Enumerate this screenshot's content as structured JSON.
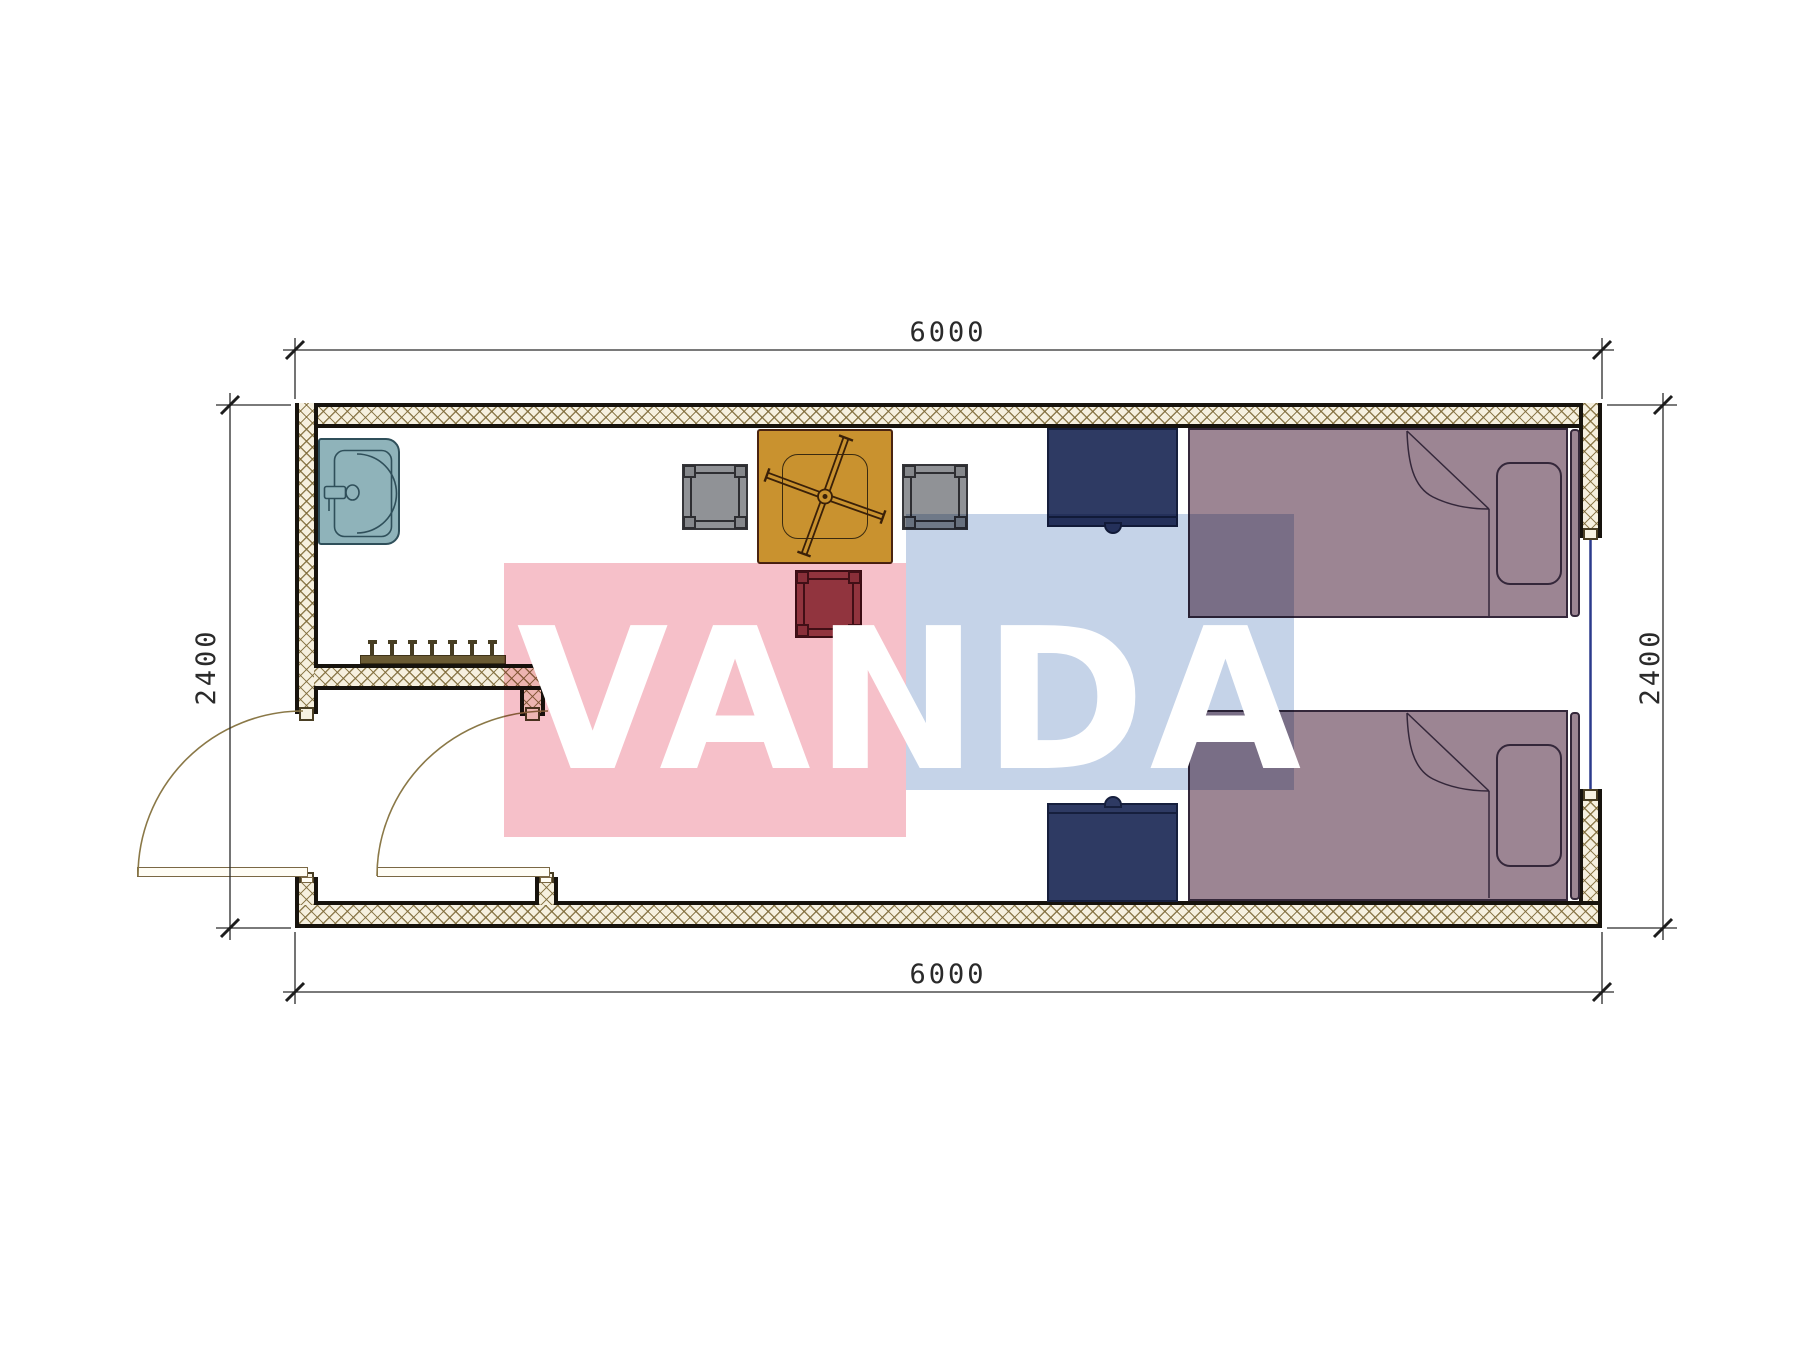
{
  "document": {
    "type": "architectural floor plan of a 6000x2400 container room with two beds",
    "background_color": "#ffffff"
  },
  "dimensions": {
    "top_width_mm": "6000",
    "bottom_width_mm": "6000",
    "left_height_mm": "2400",
    "right_height_mm": "2400"
  },
  "watermark": {
    "text": "VANDA",
    "pink_color": "#f6c0c9",
    "blue_color": "#c5d3e8",
    "text_color": "#ffffff"
  },
  "palette": {
    "wall_hatch_bg": "#f6f0df",
    "wall_hatch_line": "#7d6937",
    "wall_edge": "#17130d",
    "sink": "#8fb3ba",
    "table": "#c9922f",
    "chair_gray": "#909296",
    "chair_red": "#96454e",
    "nightstand_navy": "#2e3a63",
    "bed_mauve": "#9c8593",
    "door_line": "#8a7847",
    "window_line": "#2b3a8c",
    "dimension_line": "#2a2a2a"
  },
  "furniture": [
    "sink",
    "coat-rack",
    "square-table-with-fan",
    "chair-left",
    "chair-right",
    "chair-bottom-red",
    "nightstand-top",
    "nightstand-bottom",
    "bed-top",
    "bed-bottom"
  ],
  "openings": [
    "entry-door-left-wall",
    "inner-door-vestibule",
    "window-right-wall"
  ]
}
